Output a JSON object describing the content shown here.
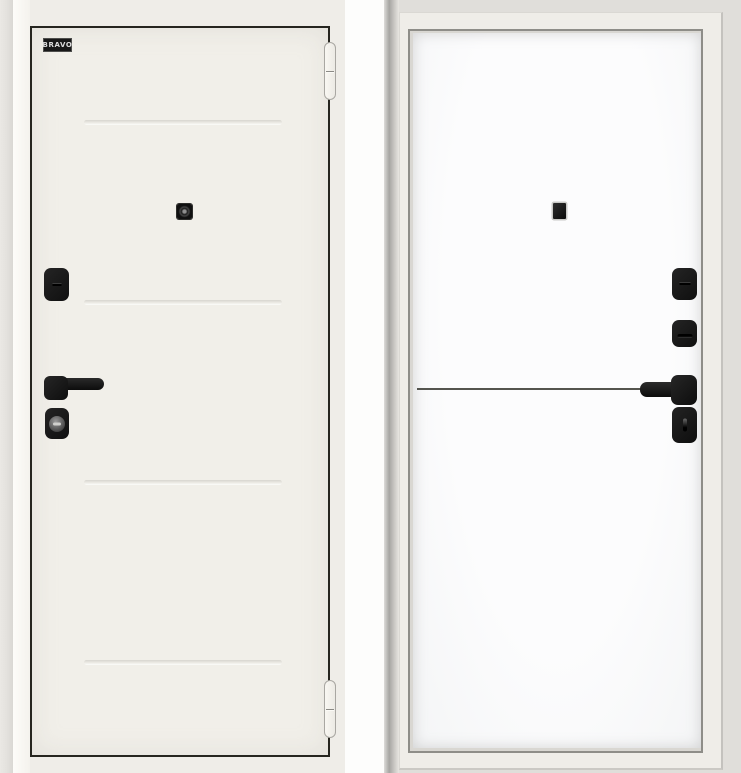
{
  "brand": {
    "logo_text": "BRAVO",
    "badge_background": "#181818",
    "badge_text_color": "#dedede"
  },
  "colors": {
    "left_panel_background": "#efede8",
    "left_leaf_fill": "#f1efe9",
    "leaf_outline": "#26251f",
    "groove_shadow": "#d7d5cf",
    "hardware_black": "#141414",
    "gap_white": "#fdfdfc",
    "right_panel_background": "#e0deda",
    "frame_casing_fill": "#efede8",
    "frame_reveal_line": "#8e8d88",
    "right_leaf_fill": "#fbfbfc",
    "decor_line_color": "#54544e",
    "hinge_fill": "#f4f2ed"
  }
}
